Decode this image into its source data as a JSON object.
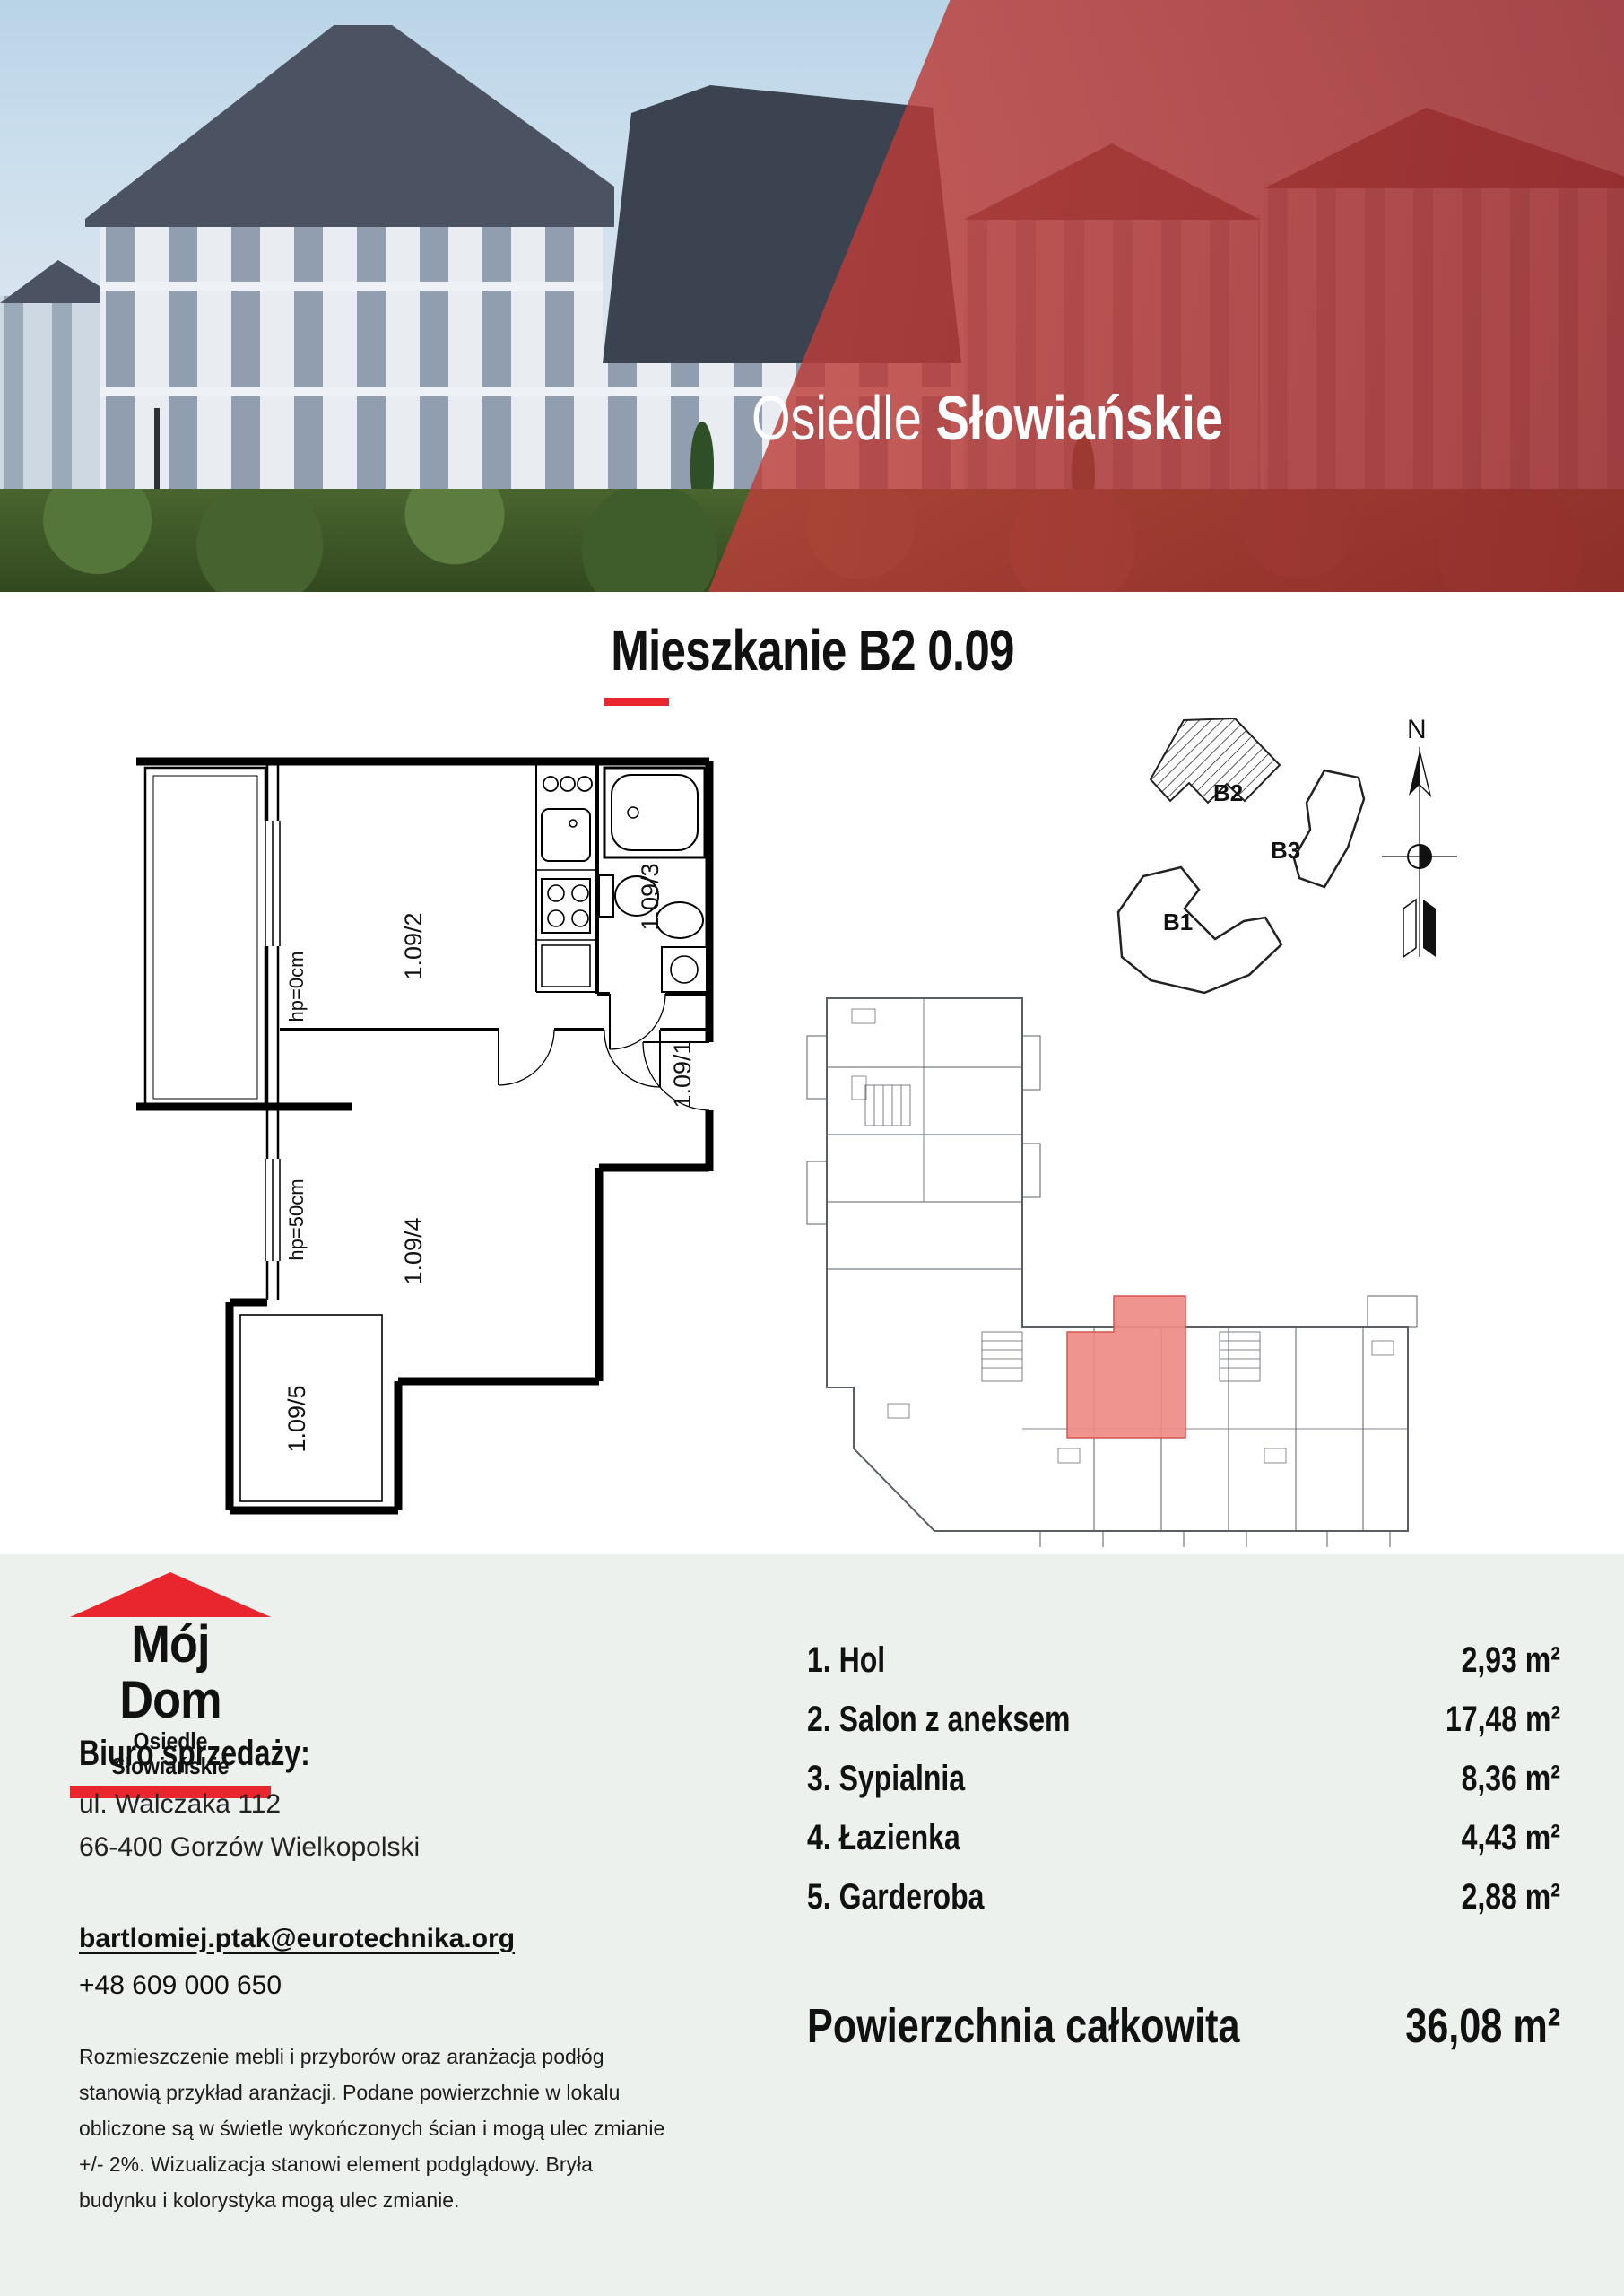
{
  "hero": {
    "title_regular": "Osiedle",
    "title_bold": "Słowiańskie"
  },
  "page": {
    "title": "Mieszkanie B2 0.09"
  },
  "floor_plan": {
    "labels": {
      "room1": "1.09/1",
      "room2": "1.09/2",
      "room3": "1.09/3",
      "room4": "1.09/4",
      "room5": "1.09/5",
      "sill_salon": "hp=0cm",
      "sill_bedroom": "hp=50cm"
    }
  },
  "site_plan": {
    "building_b1": "B1",
    "building_b2": "B2",
    "building_b3": "B3",
    "compass_north": "N"
  },
  "logo": {
    "line1": "Mój Dom",
    "line2": "Osiedle Słowiańskie"
  },
  "contact": {
    "heading": "Biuro sprzedaży:",
    "address1": "ul. Walczaka 112",
    "address2": "66-400 Gorzów Wielkopolski",
    "email": "bartlomiej.ptak@eurotechnika.org",
    "phone": "+48 609 000 650"
  },
  "disclaimer": {
    "line1": "Rozmieszczenie mebli i przyborów oraz aranżacja podłóg",
    "line2": "stanowią przykład aranżacji. Podane powierzchnie w lokalu",
    "line3": "obliczone są w świetle wykończonych ścian i mogą ulec zmianie",
    "line4": "+/- 2%. Wizualizacja stanowi element podglądowy. Bryła",
    "line5": "budynku i kolorystyka mogą ulec zmianie."
  },
  "rooms": {
    "items": [
      {
        "label": "1. Hol",
        "area": "2,93 m²"
      },
      {
        "label": "2. Salon z aneksem",
        "area": "17,48 m²"
      },
      {
        "label": "3. Sypialnia",
        "area": "8,36 m²"
      },
      {
        "label": "4. Łazienka",
        "area": "4,43 m²"
      },
      {
        "label": "5. Garderoba",
        "area": "2,88 m²"
      }
    ],
    "total_label": "Powierzchnia całkowita",
    "total_value": "36,08 m²"
  },
  "colors": {
    "accent_red": "#e9262e",
    "section_background": "#edf1ee",
    "unit_highlight": "#ee8b84",
    "hero_overlay": "#ba3a36"
  }
}
